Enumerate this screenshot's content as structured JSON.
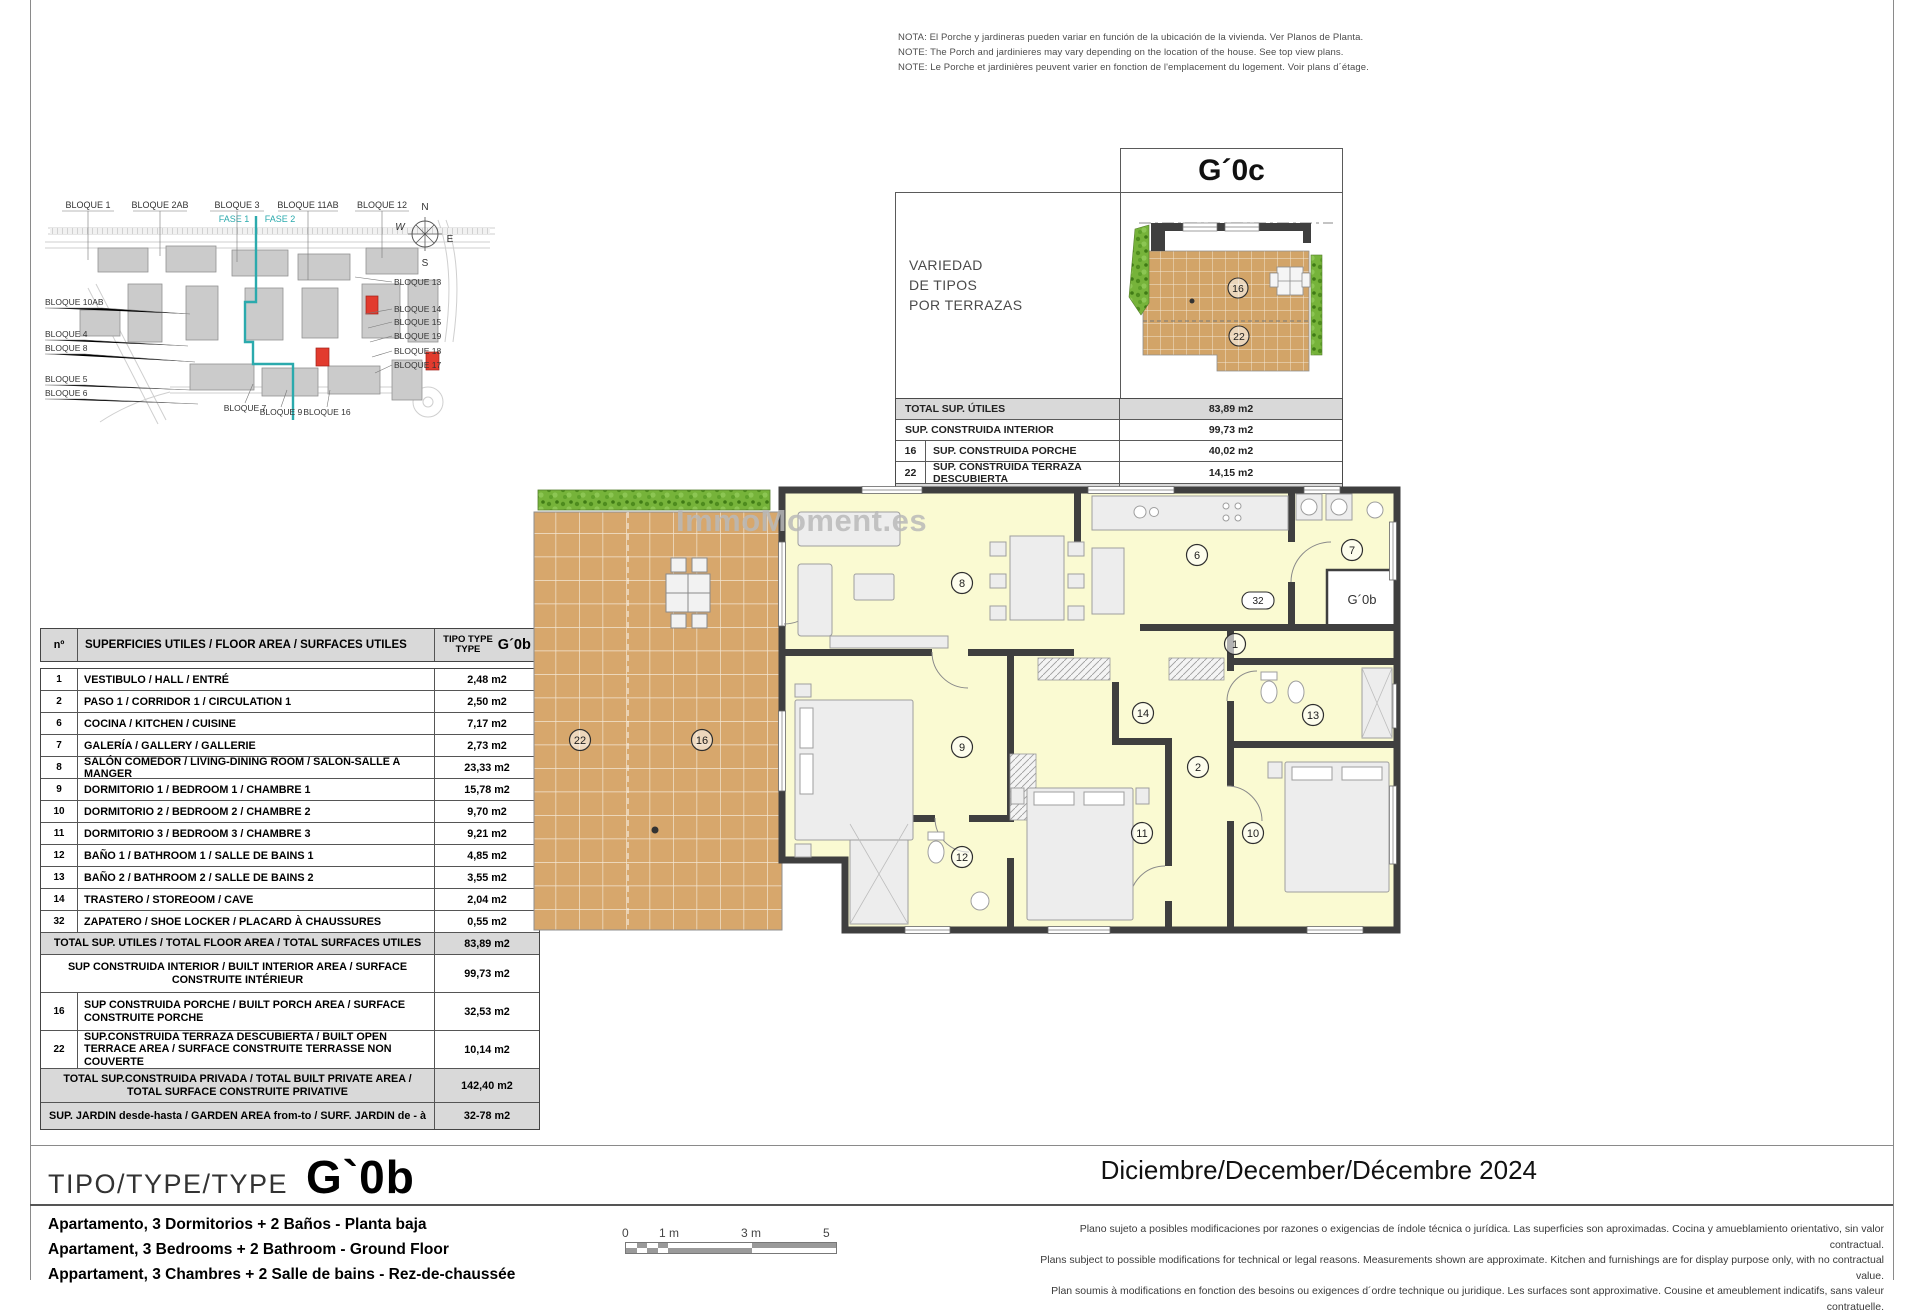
{
  "notes": {
    "es": "NOTA: El Porche y jardineras pueden variar en función de la ubicación de la vivienda. Ver Planos de Planta.",
    "en": "NOTE: The Porch and jardinieres may vary depending on the location of the house. See top view plans.",
    "fr": "NOTE: Le Porche et jardinières peuvent varier en fonction de l'emplacement du logement. Voir plans d´étage."
  },
  "site_plan": {
    "top_labels": [
      "BLOQUE 1",
      "BLOQUE 2AB",
      "BLOQUE 3",
      "BLOQUE 11AB",
      "BLOQUE 12"
    ],
    "phase_labels": [
      "FASE 1",
      "FASE 2"
    ],
    "left_labels": [
      "BLOQUE 10AB",
      "BLOQUE 4",
      "BLOQUE 8",
      "BLOQUE 5",
      "BLOQUE 6"
    ],
    "right_labels": [
      "BLOQUE 13",
      "BLOQUE 14",
      "BLOQUE 15",
      "BLOQUE 19",
      "BLOQUE 18",
      "BLOQUE 17"
    ],
    "bottom_labels": [
      "BLOQUE 7",
      "BLOQUE 9",
      "BLOQUE 16"
    ],
    "compass": {
      "n": "N",
      "s": "S",
      "e": "E",
      "w": "W"
    },
    "phase_color": "#2BAAAD",
    "highlight_color": "#E23B2E"
  },
  "variant_box": {
    "title": "G´0c",
    "subtitle_lines": [
      "VARIEDAD",
      "DE TIPOS",
      "POR TERRAZAS"
    ],
    "plan_markers": {
      "porch": "16",
      "terrace": "22"
    },
    "rows": [
      {
        "num": "",
        "label": "TOTAL SUP. ÚTILES",
        "value": "83,89 m2"
      },
      {
        "num": "",
        "label": "SUP. CONSTRUIDA INTERIOR",
        "value": "99,73 m2"
      },
      {
        "num": "16",
        "label": "SUP. CONSTRUIDA  PORCHE",
        "value": "40,02 m2"
      },
      {
        "num": "22",
        "label": "SUP. CONSTRUIDA TERRAZA DESCUBIERTA",
        "value": "14,15 m2"
      },
      {
        "num": "",
        "label": "TOTAL SUP. CONSTRUIDA PRIVADA",
        "value": "153,90 m2"
      }
    ]
  },
  "area_table": {
    "header": {
      "num": "nº",
      "label": "SUPERFICIES UTILES / FLOOR AREA / SURFACES UTILES",
      "type_l1": "TIPO TYPE",
      "type_l2": "TYPE",
      "type_code": "G´0b"
    },
    "rows": [
      {
        "num": "1",
        "label": "VESTIBULO / HALL / ENTRÉ",
        "value": "2,48 m2"
      },
      {
        "num": "2",
        "label": "PASO 1 / CORRIDOR 1 / CIRCULATION 1",
        "value": "2,50 m2"
      },
      {
        "num": "6",
        "label": "COCINA / KITCHEN / CUISINE",
        "value": "7,17 m2"
      },
      {
        "num": "7",
        "label": "GALERÍA / GALLERY / GALLERIE",
        "value": "2,73 m2"
      },
      {
        "num": "8",
        "label": "SALÓN COMEDOR  / LIVING-DINING ROOM / SALON-SALLE A MANGER",
        "value": "23,33 m2"
      },
      {
        "num": "9",
        "label": "DORMITORIO 1 / BEDROOM 1 / CHAMBRE 1",
        "value": "15,78 m2"
      },
      {
        "num": "10",
        "label": "DORMITORIO 2 / BEDROOM 2 / CHAMBRE 2",
        "value": "9,70 m2"
      },
      {
        "num": "11",
        "label": "DORMITORIO 3 / BEDROOM 3 / CHAMBRE 3",
        "value": "9,21 m2"
      },
      {
        "num": "12",
        "label": "BAÑO 1 / BATHROOM 1 / SALLE DE BAINS 1",
        "value": "4,85 m2"
      },
      {
        "num": "13",
        "label": "BAÑO 2 / BATHROOM 2 / SALLE DE BAINS 2",
        "value": "3,55 m2"
      },
      {
        "num": "14",
        "label": "TRASTERO / STOREOOM / CAVE",
        "value": "2,04 m2"
      },
      {
        "num": "32",
        "label": "ZAPATERO / SHOE LOCKER / PLACARD À CHAUSSURES",
        "value": "0,55 m2"
      }
    ],
    "totals": [
      {
        "num": "",
        "label": "TOTAL SUP. UTILES / TOTAL FLOOR AREA / TOTAL SURFACES UTILES",
        "value": "83,89 m2"
      },
      {
        "num": "",
        "label": "SUP CONSTRUIDA INTERIOR / BUILT INTERIOR AREA /  SURFACE CONSTRUITE INTÉRIEUR",
        "value": "99,73 m2"
      },
      {
        "num": "16",
        "label": "SUP CONSTRUIDA PORCHE  / BUILT PORCH  AREA / SURFACE CONSTRUITE PORCHE",
        "value": "32,53 m2"
      },
      {
        "num": "22",
        "label": "SUP.CONSTRUIDA TERRAZA DESCUBIERTA  / BUILT OPEN TERRACE AREA / SURFACE CONSTRUITE TERRASSE NON COUVERTE",
        "value": "10,14 m2"
      },
      {
        "num": "",
        "label": "TOTAL SUP.CONSTRUIDA PRIVADA / TOTAL  BUILT PRIVATE AREA / TOTAL SURFACE CONSTRUITE PRIVATIVE",
        "value": "142,40 m2"
      },
      {
        "num": "",
        "label": "SUP. JARDIN desde-hasta / GARDEN AREA from-to / SURF. JARDIN  de - à",
        "value": "32-78 m2"
      }
    ]
  },
  "floor_plan": {
    "watermark": "ImmoMoment.es",
    "markers": {
      "living": "8",
      "kitchen": "6",
      "gallery": "7",
      "hall": "1",
      "bedroom1": "9",
      "storeroom": "14",
      "bathroom2": "13",
      "corridor": "2",
      "bedroom3": "11",
      "bedroom2": "10",
      "bathroom1": "12",
      "terrace": "22",
      "porch": "16",
      "shoe_locker": "32",
      "neighbor": "G´0b"
    }
  },
  "footer": {
    "type_label": "TIPO/TYPE/TYPE",
    "type_code": "G`0b",
    "date": "Diciembre/December/Décembre 2024",
    "descriptions": {
      "es": "Apartamento, 3 Dormitorios + 2 Baños - Planta baja",
      "en": "Apartament, 3 Bedrooms + 2 Bathroom - Ground Floor",
      "fr": "Appartament, 3 Chambres + 2 Salle de bains - Rez-de-chaussée"
    },
    "scale_ticks": [
      "0",
      "1 m",
      "3 m",
      "5 m"
    ],
    "disclaimers": {
      "es": "Plano sujeto a posibles modificaciones por razones o exigencias de índole técnica o jurídica. Las superficies son aproximadas. Cocina y amueblamiento orientativo, sin valor contractual.",
      "en": "Plans subject to possible modifications for technical or legal reasons. Measurements shown are approximate. Kitchen and furnishings are for display purpose only, with no contractual value.",
      "fr": "Plan soumis à modifications en fonction des besoins ou exigences d´ordre technique ou juridique. Les surfaces sont approximative. Cousine et ameublement indicatifs, sans valeur contratuelle."
    }
  }
}
